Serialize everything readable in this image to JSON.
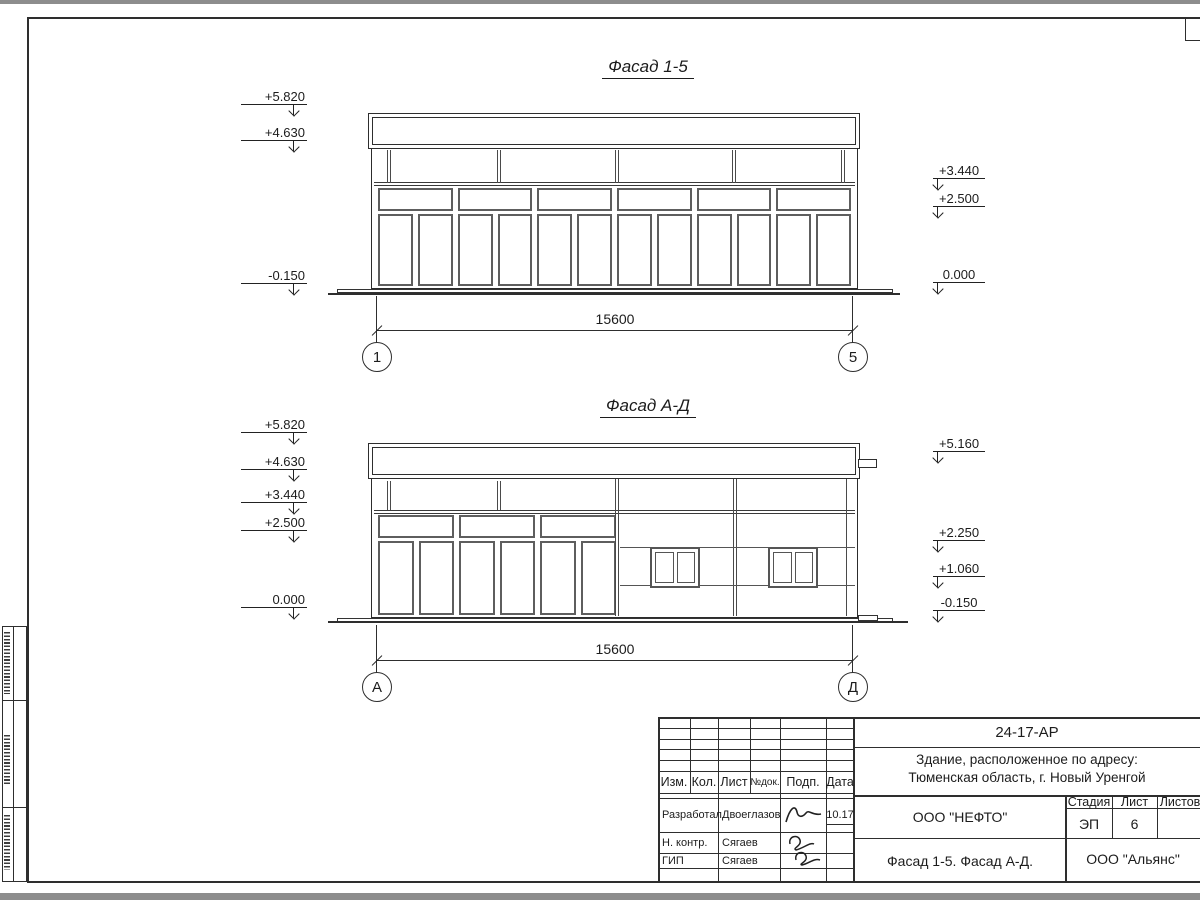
{
  "facade1": {
    "title": "Фасад 1-5",
    "marks_left": [
      "+5.820",
      "+4.630",
      "-0.150"
    ],
    "marks_right": [
      "+3.440",
      "+2.500",
      "0.000"
    ],
    "dimension": "15600",
    "axis_left": "1",
    "axis_right": "5"
  },
  "facade2": {
    "title": "Фасад А-Д",
    "marks_left": [
      "+5.820",
      "+4.630",
      "+3.440",
      "+2.500",
      "0.000"
    ],
    "marks_right": [
      "+5.160",
      "+2.250",
      "+1.060",
      "-0.150"
    ],
    "dimension": "15600",
    "axis_left": "А",
    "axis_right": "Д"
  },
  "title_block": {
    "doc_number": "24-17-АР",
    "address_line1": "Здание, расположенное по адресу:",
    "address_line2": "Тюменская область, г. Новый Уренгой",
    "cols": {
      "izm": "Изм.",
      "kol": "Кол.",
      "list": "Лист",
      "ndok": "№док.",
      "podp": "Подп.",
      "data": "Дата"
    },
    "rows": [
      {
        "role": "Разработал",
        "name": "Двоеглазов",
        "date": "10.17"
      },
      {
        "role": "Н. контр.",
        "name": "Сягаев",
        "date": ""
      },
      {
        "role": "ГИП",
        "name": "Сягаев",
        "date": ""
      }
    ],
    "designer": "ООО \"НЕФТО\"",
    "drawing_title": "Фасад 1-5. Фасад А-Д.",
    "stage_label": "Стадия",
    "list_label": "Лист",
    "listov_label": "Листов",
    "stage": "ЭП",
    "list_no": "6",
    "listov": "",
    "contractor": "ООО \"Альянс\""
  }
}
